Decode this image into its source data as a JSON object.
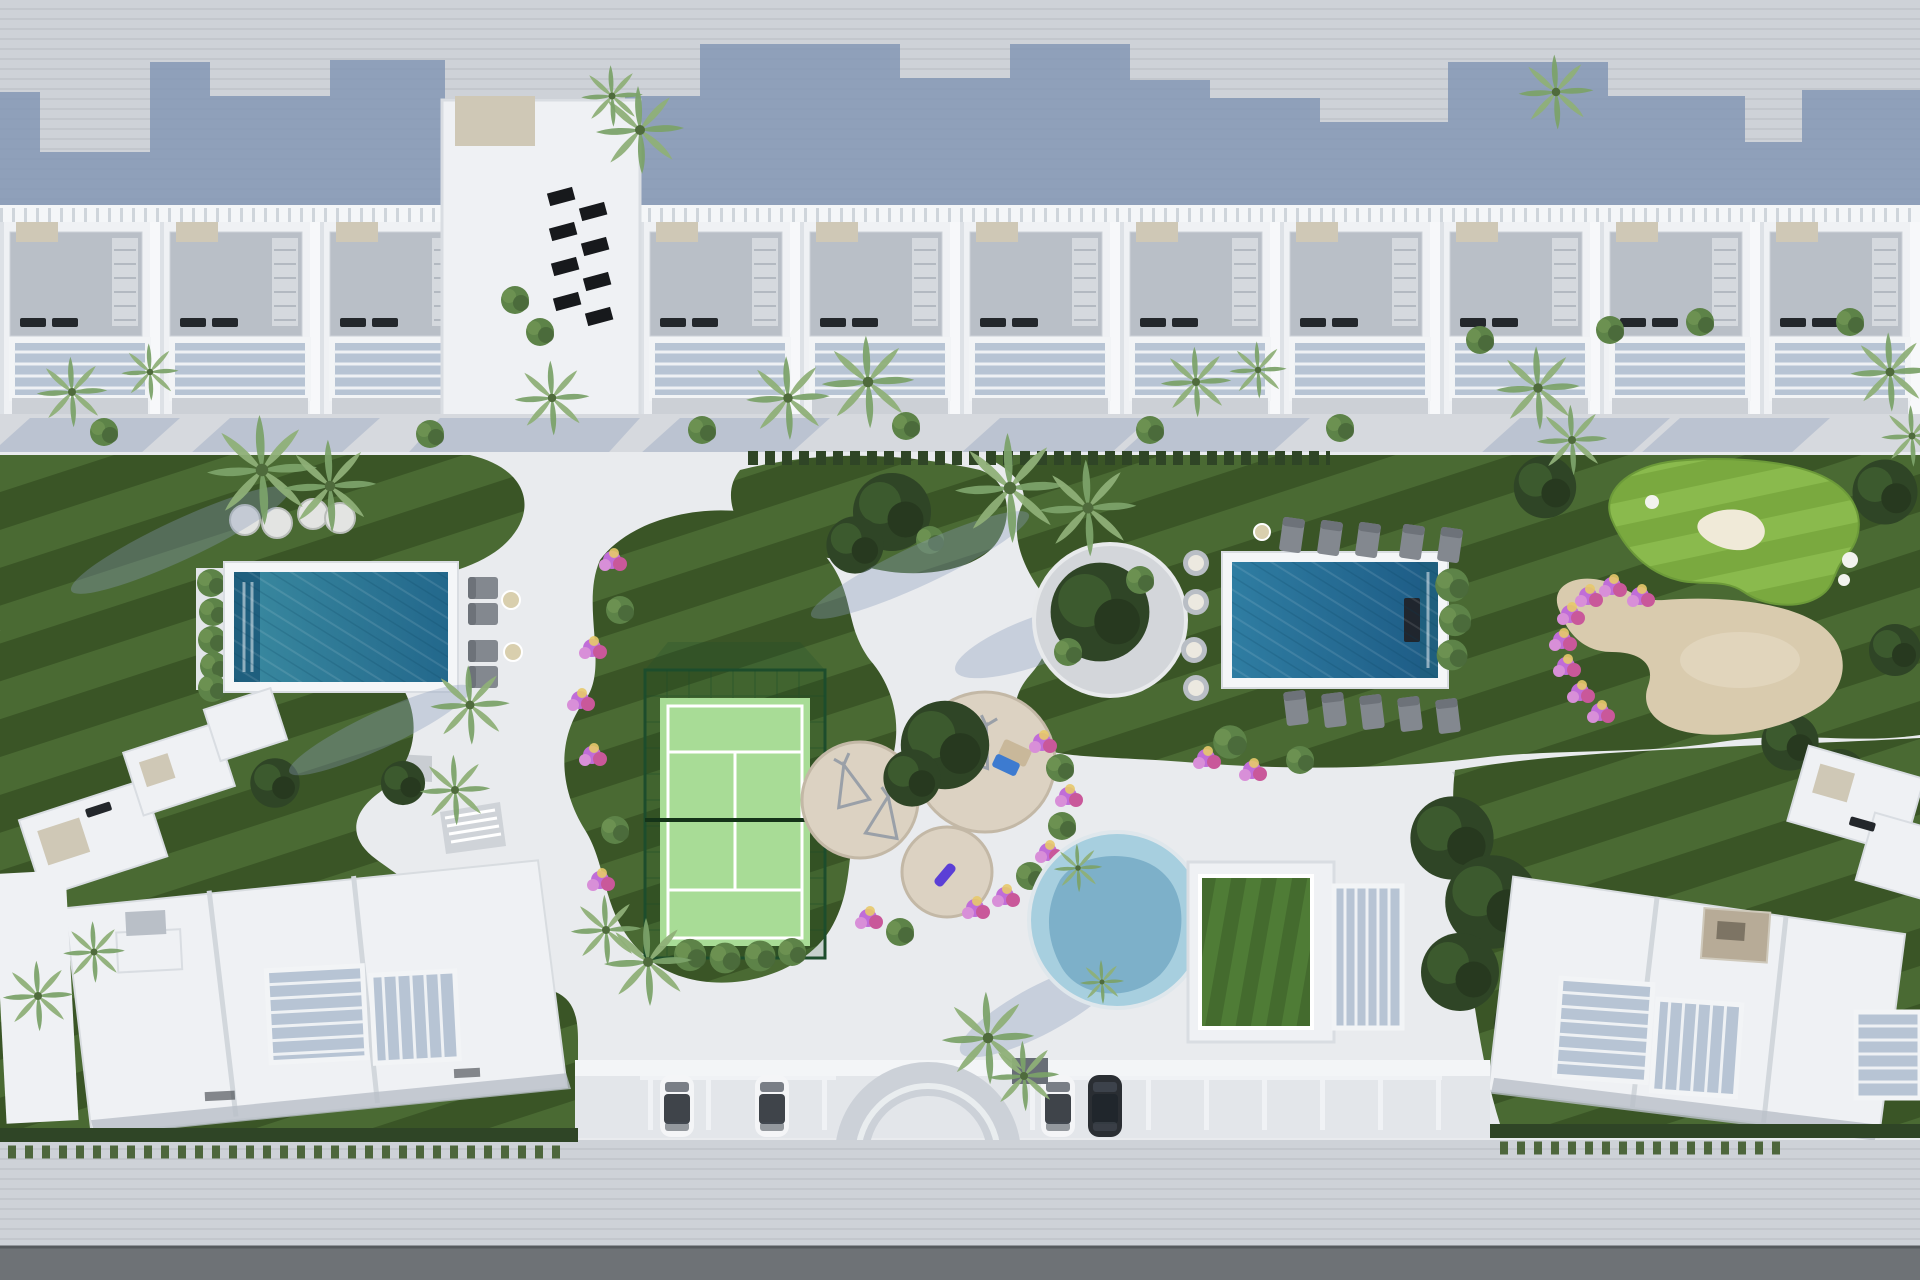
{
  "scene": {
    "description": "Aerial top-down 3D render of a white Mediterranean residential resort: a townhouse row at top, landscaped striped lawns with two rectangular pools, a padel court, a putting green with sand bunker, a round lagoon pool, a grass-roofed clubhouse, playground circles with teepees, two angled apartment buildings at the bottom, and an arched entrance with parking along the road.",
    "palette": {
      "pavement": "#ced2d8",
      "pavement_stripe": "#c3c7cd",
      "cast_shadow": "#8195b3",
      "building_white": "#eff1f4",
      "building_trim": "#d9dde2",
      "roof_gray": "#b9bfc7",
      "roof_beige": "#cfc8b6",
      "glass_blue": "#b7c4d4",
      "stair_gray": "#d5d9de",
      "sidewalk": "#d6d9de",
      "deck_white": "#e9ebee",
      "lawn_dark": "#3a5526",
      "lawn_stripe": "#4a6a33",
      "putting_light": "#8aba4d",
      "putting_stripe": "#7aa93f",
      "court_green": "#a8dc96",
      "cage_green": "#1d4d2c",
      "pool_teal": "#2e7e9b",
      "pool_teal_deep": "#1f5f7e",
      "lagoon_blue": "#a7cfdf",
      "lagoon_deep": "#76aac6",
      "sand": "#d9cbae",
      "sand_light": "#e4d9c2",
      "flower_pink": "#c06dd8",
      "flower_magenta": "#c9589a",
      "flower_lilac": "#d88fd8",
      "flower_yellow": "#e7c96a",
      "palm_green": "#7ca36a",
      "palm_green_light": "#8fb078",
      "bush_mid": "#5d8348",
      "tree_dark": "#2f4526",
      "road_asphalt": "#6e7276",
      "wall_white": "#f3f5f7",
      "arch_gray": "#ccd1d8",
      "car_white": "#f4f5f7",
      "car_dark": "#2a2e33",
      "lounger_gray": "#83888f",
      "stool_gray": "#b9bec5",
      "boulder": "#e3e4e2"
    },
    "counts": {
      "townhouse_units": 11,
      "garden_towers": 1,
      "solar_panels": 8,
      "rectangular_pools": 2,
      "round_lagoon_pools": 1,
      "padel_courts": 1,
      "putting_greens": 1,
      "sand_bunkers": 1,
      "playground_circles": 3,
      "teepees": 3,
      "lawn_boulders": 4,
      "pool_stools": 8,
      "sun_loungers": 14,
      "parked_cars": 4,
      "entrance_arches": 1
    },
    "cars": [
      {
        "slot": 1,
        "color_name": "white"
      },
      {
        "slot": 2,
        "color_name": "white"
      },
      {
        "slot": 3,
        "color_name": "white"
      },
      {
        "slot": 4,
        "color_name": "dark gray"
      }
    ]
  }
}
